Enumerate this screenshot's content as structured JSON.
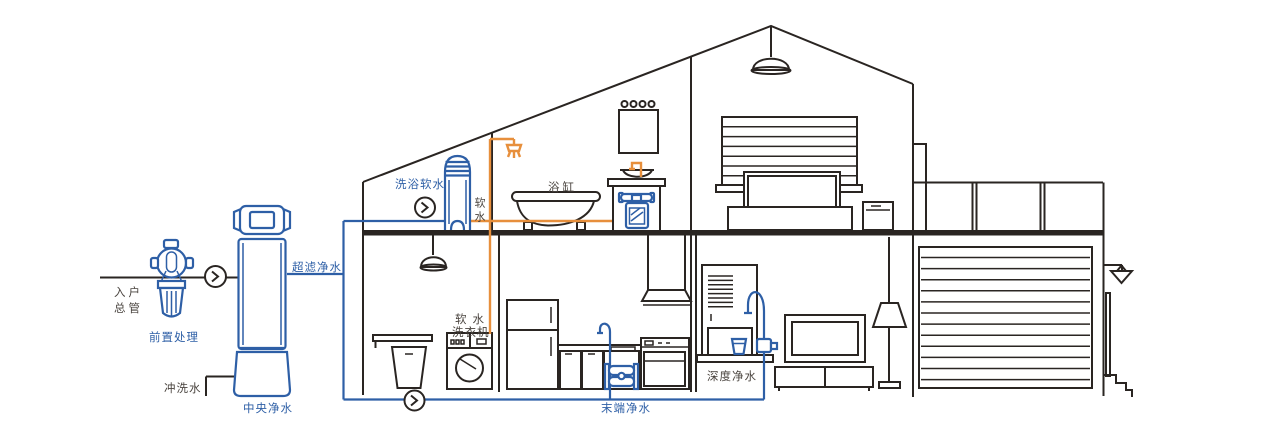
{
  "colors": {
    "line_dark": "#2A2522",
    "pipe_blue": "#2E5FA6",
    "pipe_orange": "#E78F3C",
    "text_dark": "#4A443F"
  },
  "icons": {
    "flow_direction": "circled-chevron-right",
    "shower": "shower-head",
    "ceiling_light": "pendant-lamp"
  },
  "labels": {
    "inlet_line1": "入户",
    "inlet_line2": "总管",
    "pre_treatment": "前置处理",
    "central_purifier": "中央净水",
    "flush_water": "冲洗水",
    "ultrafiltration": "超滤净水",
    "bath_softener": "洗浴软水",
    "soft_water": "软水",
    "bathtub": "浴缸",
    "washer_line1": "软水",
    "washer_line2": "洗衣机",
    "terminal_purifier": "末端净水",
    "deep_purifier": "深度净水"
  }
}
